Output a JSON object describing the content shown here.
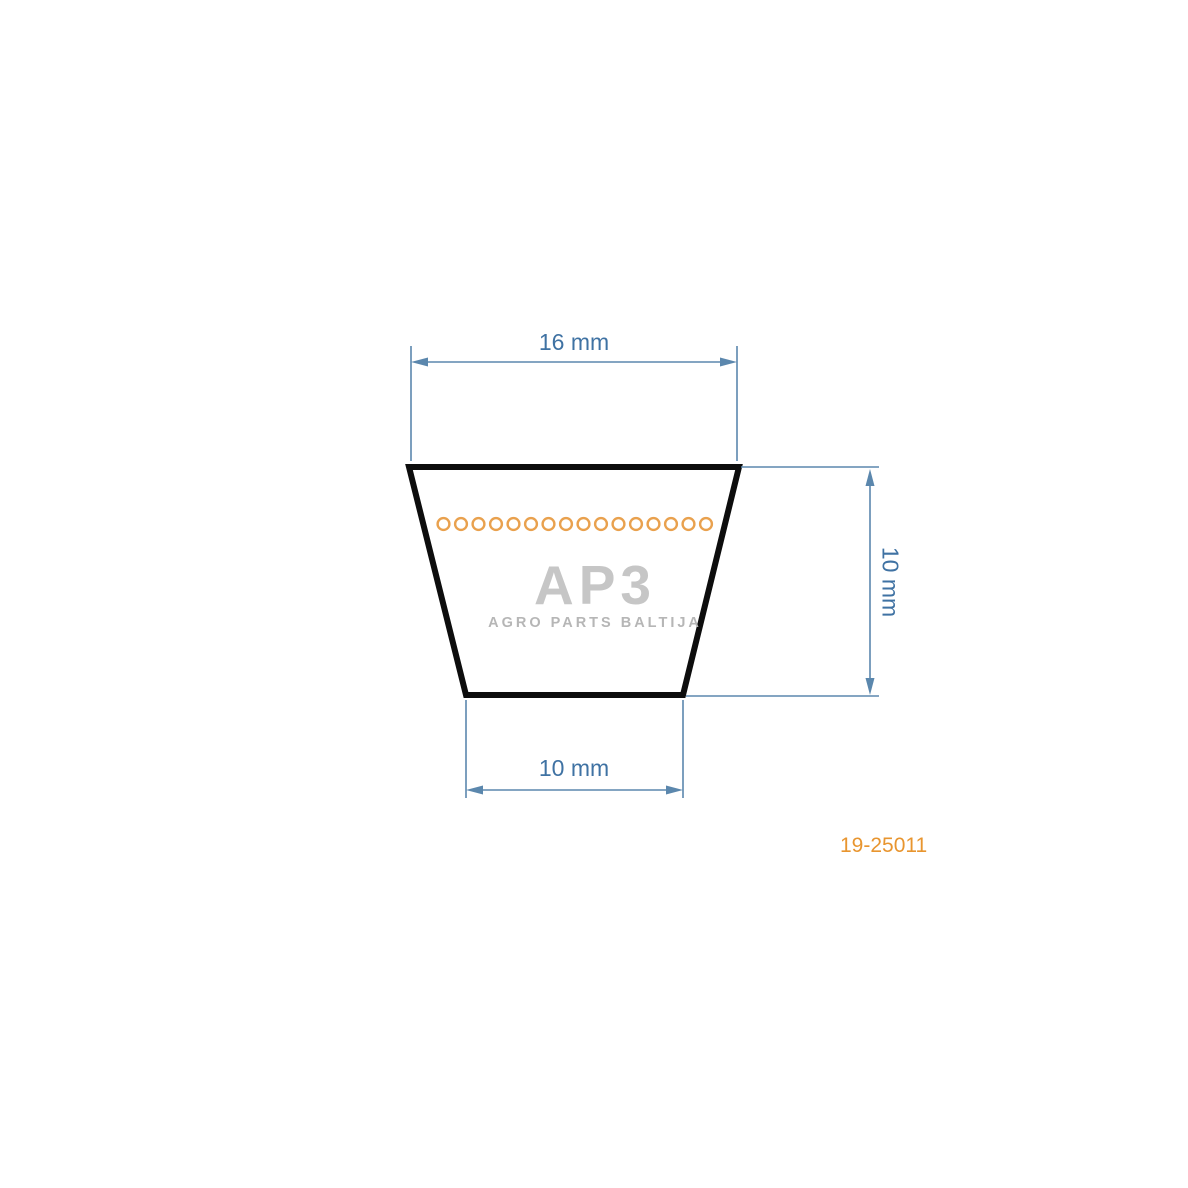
{
  "diagram": {
    "title": "V-belt cross-section technical drawing",
    "dimensions": {
      "top_width": {
        "label": "16 mm",
        "value": 16,
        "unit": "mm"
      },
      "bottom_width": {
        "label": "10 mm",
        "value": 10,
        "unit": "mm"
      },
      "height": {
        "label": "10 mm",
        "value": 10,
        "unit": "mm"
      }
    },
    "cord_row": {
      "circle_count": 16,
      "stroke_color": "#e9a14e"
    },
    "outline_color": "#0d0d0d",
    "dimension_color": "#5b87ad",
    "dimension_text_color": "#3f72a3"
  },
  "watermark": {
    "logo_text": "AP3",
    "subtitle": "AGRO PARTS BALTIJA",
    "logo_color": "#c6c6c6",
    "subtitle_color": "#b6b6b6"
  },
  "part_number": {
    "text": "19-25011",
    "color": "#e8952f"
  }
}
